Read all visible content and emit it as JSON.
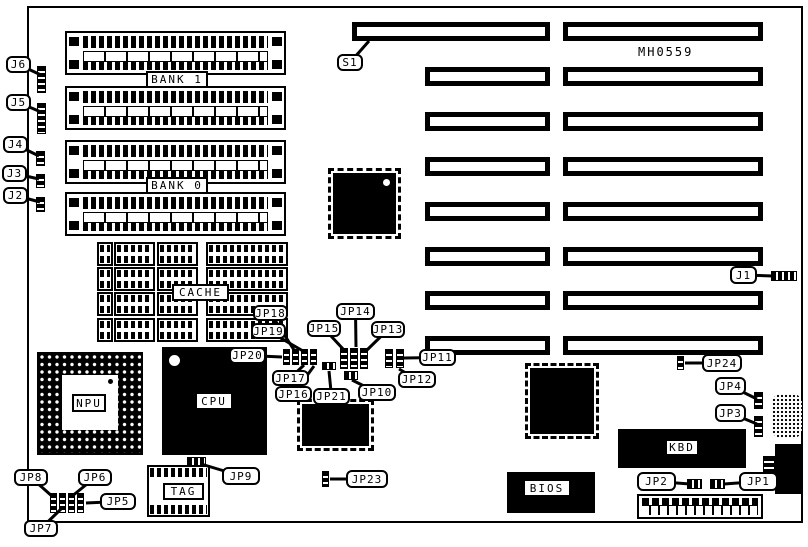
{
  "board": {
    "id_text": "MH0559",
    "ink": "#000000",
    "background": "#ffffff",
    "outline": {
      "x": 27,
      "y": 6,
      "w": 776,
      "h": 517
    },
    "id_pos": {
      "x": 638,
      "y": 45
    }
  },
  "labels": {
    "bank1": "BANK 1",
    "bank0": "BANK 0",
    "cache": "CACHE",
    "tag": "TAG",
    "npu": "NPU",
    "cpu": "CPU",
    "kbd": "KBD",
    "bios": "BIOS"
  },
  "boxed_labels": [
    {
      "key": "bank1",
      "text": "BANK 1",
      "x": 146,
      "y": 71,
      "w": 62,
      "h": 17
    },
    {
      "key": "bank0",
      "text": "BANK 0",
      "x": 146,
      "y": 177,
      "w": 62,
      "h": 17
    },
    {
      "key": "cache",
      "text": "CACHE",
      "x": 172,
      "y": 284,
      "w": 57,
      "h": 17
    },
    {
      "key": "tag",
      "text": "TAG",
      "x": 163,
      "y": 483,
      "w": 41,
      "h": 17
    },
    {
      "key": "npu",
      "text": "NPU",
      "x": 72,
      "y": 394,
      "w": 34,
      "h": 18
    },
    {
      "key": "cpu",
      "text": "CPU",
      "x": 195,
      "y": 392,
      "w": 38,
      "h": 18
    },
    {
      "key": "kbd",
      "text": "KBD",
      "x": 665,
      "y": 439,
      "w": 34,
      "h": 17
    },
    {
      "key": "bios",
      "text": "BIOS",
      "x": 523,
      "y": 479,
      "w": 48,
      "h": 18
    }
  ],
  "expansion_slots": [
    {
      "x": 352,
      "y": 22,
      "w": 198,
      "h": 19
    },
    {
      "x": 563,
      "y": 22,
      "w": 200,
      "h": 19
    },
    {
      "x": 425,
      "y": 67,
      "w": 125,
      "h": 19
    },
    {
      "x": 563,
      "y": 67,
      "w": 200,
      "h": 19
    },
    {
      "x": 425,
      "y": 112,
      "w": 125,
      "h": 19
    },
    {
      "x": 563,
      "y": 112,
      "w": 200,
      "h": 19
    },
    {
      "x": 425,
      "y": 157,
      "w": 125,
      "h": 19
    },
    {
      "x": 563,
      "y": 157,
      "w": 200,
      "h": 19
    },
    {
      "x": 425,
      "y": 202,
      "w": 125,
      "h": 19
    },
    {
      "x": 563,
      "y": 202,
      "w": 200,
      "h": 19
    },
    {
      "x": 425,
      "y": 247,
      "w": 125,
      "h": 19
    },
    {
      "x": 563,
      "y": 247,
      "w": 200,
      "h": 19
    },
    {
      "x": 425,
      "y": 291,
      "w": 125,
      "h": 19
    },
    {
      "x": 563,
      "y": 291,
      "w": 200,
      "h": 19
    },
    {
      "x": 425,
      "y": 336,
      "w": 125,
      "h": 19
    },
    {
      "x": 563,
      "y": 336,
      "w": 200,
      "h": 19
    }
  ],
  "simm_sockets": [
    {
      "x": 65,
      "y": 31,
      "w": 221,
      "h": 44
    },
    {
      "x": 65,
      "y": 86,
      "w": 221,
      "h": 44
    },
    {
      "x": 65,
      "y": 140,
      "w": 221,
      "h": 44
    },
    {
      "x": 65,
      "y": 192,
      "w": 221,
      "h": 44
    }
  ],
  "cache_sockets": [
    {
      "x": 97,
      "y": 242,
      "w": 16,
      "h": 24
    },
    {
      "x": 114,
      "y": 242,
      "w": 41,
      "h": 24
    },
    {
      "x": 157,
      "y": 242,
      "w": 41,
      "h": 24
    },
    {
      "x": 206,
      "y": 242,
      "w": 82,
      "h": 24
    },
    {
      "x": 97,
      "y": 267,
      "w": 16,
      "h": 24
    },
    {
      "x": 114,
      "y": 267,
      "w": 41,
      "h": 24
    },
    {
      "x": 157,
      "y": 267,
      "w": 41,
      "h": 24
    },
    {
      "x": 206,
      "y": 267,
      "w": 82,
      "h": 24
    },
    {
      "x": 97,
      "y": 292,
      "w": 16,
      "h": 24
    },
    {
      "x": 114,
      "y": 292,
      "w": 41,
      "h": 24
    },
    {
      "x": 157,
      "y": 292,
      "w": 41,
      "h": 24
    },
    {
      "x": 206,
      "y": 292,
      "w": 82,
      "h": 24
    },
    {
      "x": 97,
      "y": 318,
      "w": 16,
      "h": 24
    },
    {
      "x": 114,
      "y": 318,
      "w": 41,
      "h": 24
    },
    {
      "x": 157,
      "y": 318,
      "w": 41,
      "h": 24
    },
    {
      "x": 206,
      "y": 318,
      "w": 82,
      "h": 24
    }
  ],
  "tag_socket": {
    "x": 147,
    "y": 465,
    "w": 63,
    "h": 52
  },
  "qfp_chips": [
    {
      "x": 333,
      "y": 173,
      "w": 63,
      "h": 61,
      "dot": "tr"
    },
    {
      "x": 302,
      "y": 404,
      "w": 67,
      "h": 42,
      "dot": ""
    },
    {
      "x": 530,
      "y": 368,
      "w": 64,
      "h": 66,
      "dot": ""
    }
  ],
  "npu_socket": {
    "x": 37,
    "y": 352,
    "w": 106,
    "h": 103,
    "inner": {
      "x": 62,
      "y": 375,
      "w": 56,
      "h": 55
    },
    "pin1_dot": {
      "x": 107,
      "y": 381
    }
  },
  "cpu_chip": {
    "x": 162,
    "y": 347,
    "w": 105,
    "h": 108,
    "circle": {
      "x": 169,
      "y": 355
    }
  },
  "bios_chip": {
    "x": 507,
    "y": 472,
    "w": 88,
    "h": 41
  },
  "kbd_chip": {
    "x": 618,
    "y": 429,
    "w": 128,
    "h": 39
  },
  "pin_headers": [
    {
      "name": "j6-header",
      "dir": "v",
      "x": 37,
      "y": 66,
      "w": 9,
      "h": 27
    },
    {
      "name": "j5-header",
      "dir": "v",
      "x": 37,
      "y": 103,
      "w": 9,
      "h": 31
    },
    {
      "name": "j4-header",
      "dir": "v",
      "x": 36,
      "y": 151,
      "w": 9,
      "h": 15
    },
    {
      "name": "j3-header",
      "dir": "v",
      "x": 36,
      "y": 174,
      "w": 9,
      "h": 14
    },
    {
      "name": "j2-header",
      "dir": "v",
      "x": 36,
      "y": 197,
      "w": 9,
      "h": 15
    },
    {
      "name": "j1-header",
      "dir": "h",
      "x": 771,
      "y": 271,
      "w": 26,
      "h": 10
    },
    {
      "name": "jp24-jumper",
      "dir": "v",
      "x": 677,
      "y": 356,
      "w": 7,
      "h": 14
    },
    {
      "name": "jp4-jumper",
      "dir": "v",
      "x": 754,
      "y": 392,
      "w": 9,
      "h": 17
    },
    {
      "name": "jp3-jumper",
      "dir": "v",
      "x": 754,
      "y": 416,
      "w": 9,
      "h": 21
    },
    {
      "name": "jp23-jumper",
      "dir": "v",
      "x": 322,
      "y": 471,
      "w": 7,
      "h": 16
    },
    {
      "name": "jp9-header",
      "dir": "h",
      "x": 187,
      "y": 457,
      "w": 19,
      "h": 9
    },
    {
      "name": "jp21-header",
      "dir": "h",
      "x": 322,
      "y": 362,
      "w": 14,
      "h": 8
    },
    {
      "name": "jp10-jumper",
      "dir": "h",
      "x": 344,
      "y": 371,
      "w": 14,
      "h": 9
    },
    {
      "name": "jp2-jumper",
      "dir": "h",
      "x": 687,
      "y": 479,
      "w": 15,
      "h": 10
    },
    {
      "name": "jp1-jumper",
      "dir": "h",
      "x": 710,
      "y": 479,
      "w": 15,
      "h": 10
    },
    {
      "name": "jumper-block",
      "dir": "v",
      "x": 283,
      "y": 349,
      "w": 7,
      "h": 16
    },
    {
      "name": "jumper-block",
      "dir": "v",
      "x": 292,
      "y": 349,
      "w": 7,
      "h": 16
    },
    {
      "name": "jumper-block",
      "dir": "v",
      "x": 301,
      "y": 349,
      "w": 7,
      "h": 16
    },
    {
      "name": "jumper-block",
      "dir": "v",
      "x": 310,
      "y": 349,
      "w": 7,
      "h": 16
    },
    {
      "name": "jumper-block",
      "dir": "v",
      "x": 340,
      "y": 348,
      "w": 8,
      "h": 21
    },
    {
      "name": "jumper-block",
      "dir": "v",
      "x": 350,
      "y": 348,
      "w": 8,
      "h": 21
    },
    {
      "name": "jumper-block",
      "dir": "v",
      "x": 360,
      "y": 348,
      "w": 8,
      "h": 21
    },
    {
      "name": "jumper-block",
      "dir": "v",
      "x": 385,
      "y": 349,
      "w": 8,
      "h": 19
    },
    {
      "name": "jumper-block",
      "dir": "v",
      "x": 396,
      "y": 349,
      "w": 8,
      "h": 19
    },
    {
      "name": "jumper-block",
      "dir": "v",
      "x": 50,
      "y": 493,
      "w": 7,
      "h": 20
    },
    {
      "name": "jumper-block",
      "dir": "v",
      "x": 59,
      "y": 493,
      "w": 7,
      "h": 20
    },
    {
      "name": "jumper-block",
      "dir": "v",
      "x": 68,
      "y": 493,
      "w": 7,
      "h": 20
    },
    {
      "name": "jumper-block",
      "dir": "v",
      "x": 77,
      "y": 493,
      "w": 7,
      "h": 20
    },
    {
      "name": "keyboard-comb",
      "dir": "v",
      "x": 763,
      "y": 456,
      "w": 12,
      "h": 20
    }
  ],
  "misc": {
    "battery": {
      "x": 772,
      "y": 394,
      "w": 30,
      "h": 44
    },
    "keyboard_connector": {
      "x": 775,
      "y": 444,
      "w": 28,
      "h": 50
    },
    "power_connector": {
      "x": 637,
      "y": 494,
      "w": 126,
      "h": 25
    }
  },
  "callouts": [
    {
      "label": "J6",
      "x": 6,
      "y": 56,
      "w": 25,
      "h": 17,
      "tx": 41,
      "ty": 75
    },
    {
      "label": "J5",
      "x": 6,
      "y": 94,
      "w": 25,
      "h": 17,
      "tx": 41,
      "ty": 112
    },
    {
      "label": "J4",
      "x": 3,
      "y": 136,
      "w": 25,
      "h": 17,
      "tx": 39,
      "ty": 156
    },
    {
      "label": "J3",
      "x": 2,
      "y": 165,
      "w": 25,
      "h": 17,
      "tx": 39,
      "ty": 179
    },
    {
      "label": "J2",
      "x": 3,
      "y": 187,
      "w": 25,
      "h": 17,
      "tx": 40,
      "ty": 202
    },
    {
      "label": "S1",
      "x": 337,
      "y": 54,
      "w": 26,
      "h": 17,
      "tx": 369,
      "ty": 41
    },
    {
      "label": "J1",
      "x": 730,
      "y": 266,
      "w": 27,
      "h": 18,
      "tx": 773,
      "ty": 276
    },
    {
      "label": "JP24",
      "x": 702,
      "y": 354,
      "w": 40,
      "h": 18,
      "tx": 685,
      "ty": 363
    },
    {
      "label": "JP4",
      "x": 715,
      "y": 377,
      "w": 31,
      "h": 18,
      "tx": 757,
      "ty": 399
    },
    {
      "label": "JP3",
      "x": 715,
      "y": 404,
      "w": 31,
      "h": 18,
      "tx": 757,
      "ty": 424
    },
    {
      "label": "JP18",
      "x": 253,
      "y": 305,
      "w": 35,
      "h": 16,
      "tx": 294,
      "ty": 350
    },
    {
      "label": "JP19",
      "x": 251,
      "y": 323,
      "w": 35,
      "h": 16,
      "tx": 303,
      "ty": 351
    },
    {
      "label": "JP20",
      "x": 229,
      "y": 347,
      "w": 37,
      "h": 17,
      "tx": 282,
      "ty": 357
    },
    {
      "label": "JP15",
      "x": 307,
      "y": 320,
      "w": 34,
      "h": 17,
      "tx": 344,
      "ty": 350
    },
    {
      "label": "JP14",
      "x": 336,
      "y": 303,
      "w": 39,
      "h": 17,
      "tx": 356,
      "ty": 347
    },
    {
      "label": "JP13",
      "x": 371,
      "y": 321,
      "w": 34,
      "h": 17,
      "tx": 367,
      "ty": 350
    },
    {
      "label": "JP11",
      "x": 419,
      "y": 349,
      "w": 37,
      "h": 17,
      "tx": 404,
      "ty": 358
    },
    {
      "label": "JP12",
      "x": 398,
      "y": 371,
      "w": 38,
      "h": 17,
      "tx": 399,
      "ty": 369
    },
    {
      "label": "JP10",
      "x": 358,
      "y": 384,
      "w": 38,
      "h": 17,
      "tx": 352,
      "ty": 380
    },
    {
      "label": "JP21",
      "x": 313,
      "y": 388,
      "w": 37,
      "h": 17,
      "tx": 329,
      "ty": 371
    },
    {
      "label": "JP17",
      "x": 272,
      "y": 370,
      "w": 37,
      "h": 16,
      "tx": 304,
      "ty": 365
    },
    {
      "label": "JP16",
      "x": 275,
      "y": 386,
      "w": 37,
      "h": 16,
      "tx": 314,
      "ty": 366
    },
    {
      "label": "JP9",
      "x": 222,
      "y": 467,
      "w": 38,
      "h": 18,
      "tx": 201,
      "ty": 464
    },
    {
      "label": "JP23",
      "x": 346,
      "y": 470,
      "w": 42,
      "h": 18,
      "tx": 330,
      "ty": 479
    },
    {
      "label": "JP8",
      "x": 14,
      "y": 469,
      "w": 34,
      "h": 17,
      "tx": 53,
      "ty": 497
    },
    {
      "label": "JP6",
      "x": 78,
      "y": 469,
      "w": 34,
      "h": 17,
      "tx": 71,
      "ty": 497
    },
    {
      "label": "JP5",
      "x": 100,
      "y": 493,
      "w": 36,
      "h": 17,
      "tx": 86,
      "ty": 503
    },
    {
      "label": "JP7",
      "x": 24,
      "y": 520,
      "w": 34,
      "h": 17,
      "tx": 61,
      "ty": 509
    },
    {
      "label": "JP2",
      "x": 637,
      "y": 472,
      "w": 39,
      "h": 19,
      "tx": 690,
      "ty": 484
    },
    {
      "label": "JP1",
      "x": 739,
      "y": 472,
      "w": 39,
      "h": 19,
      "tx": 724,
      "ty": 484
    }
  ]
}
